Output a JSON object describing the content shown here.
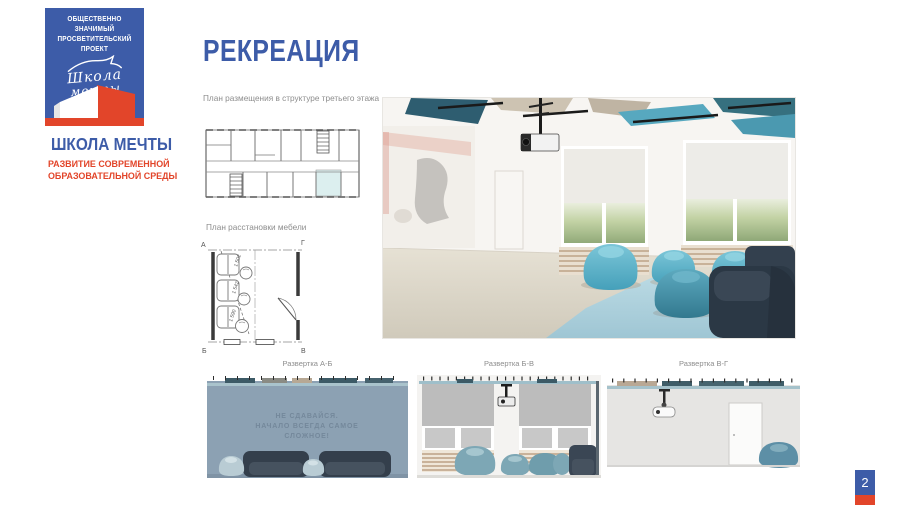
{
  "slide": {
    "number": "2",
    "colors": {
      "brand_blue": "#3d5ca8",
      "brand_red": "#e2452a",
      "accent_teal": "#57a8bf",
      "caption_gray": "#8d8d8d"
    }
  },
  "branding": {
    "badge": {
      "line1": "ОБЩЕСТВЕННО ЗНАЧИМЫЙ",
      "line2": "ПРОСВЕТИТЕЛЬСКИЙ ПРОЕКТ"
    },
    "script_logo": {
      "line1": "Школа",
      "line2": "мечты"
    },
    "org_name": "ШКОЛА МЕЧТЫ",
    "tagline": {
      "line1": "РАЗВИТИЕ СОВРЕМЕННОЙ",
      "line2": "ОБРАЗОВАТЕЛЬНОЙ СРЕДЫ"
    }
  },
  "main": {
    "title": "РЕКРЕАЦИЯ",
    "floor_plan_caption": "План размещения в структуре третьего этажа",
    "furniture_plan_caption": "План расстановки мебели"
  },
  "furniture_plan": {
    "corner_top_left": "А",
    "corner_top_right": "Г",
    "corner_bottom_left": "Б",
    "corner_bottom_right": "В",
    "dim1": "1 502",
    "dim2": "1 542",
    "dim3": "1 590"
  },
  "elevations": [
    {
      "label": "Развертка А-Б",
      "wall_text": {
        "line1": "НЕ СДАВАЙСЯ.",
        "line2": "НАЧАЛО ВСЕГДА САМОЕ",
        "line3": "СЛОЖНОЕ!"
      }
    },
    {
      "label": "Развертка Б-В"
    },
    {
      "label": "Развертка В-Г"
    }
  ]
}
